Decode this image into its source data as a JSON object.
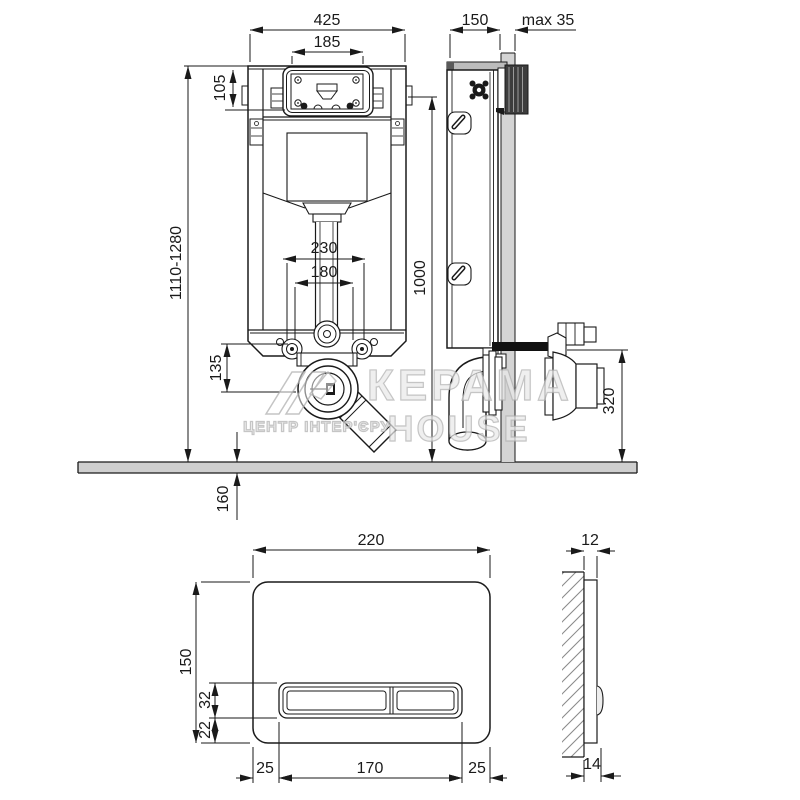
{
  "watermark": {
    "brand": "КЕРАМА",
    "brand_suffix": "HOUSE",
    "subtitle": "ЦЕНТР ІНТЕР'ЄРУ"
  },
  "dims": {
    "front": {
      "overall_width": "425",
      "access_width": "185",
      "access_height": "105",
      "height_range": "1110-1280",
      "spacing_outer": "230",
      "spacing_inner": "180",
      "outlet_drop": "135",
      "below_floor": "160"
    },
    "side": {
      "depth": "150",
      "wall_max": "max 35",
      "height_1000": "1000",
      "outlet_height": "320"
    },
    "plate_front": {
      "width": "220",
      "height": "150",
      "buttons_height": "32",
      "bottom_offset": "22",
      "margin_left": "25",
      "buttons_width": "170",
      "margin_right": "25"
    },
    "plate_side": {
      "thickness": "12",
      "total_thickness": "14"
    }
  }
}
